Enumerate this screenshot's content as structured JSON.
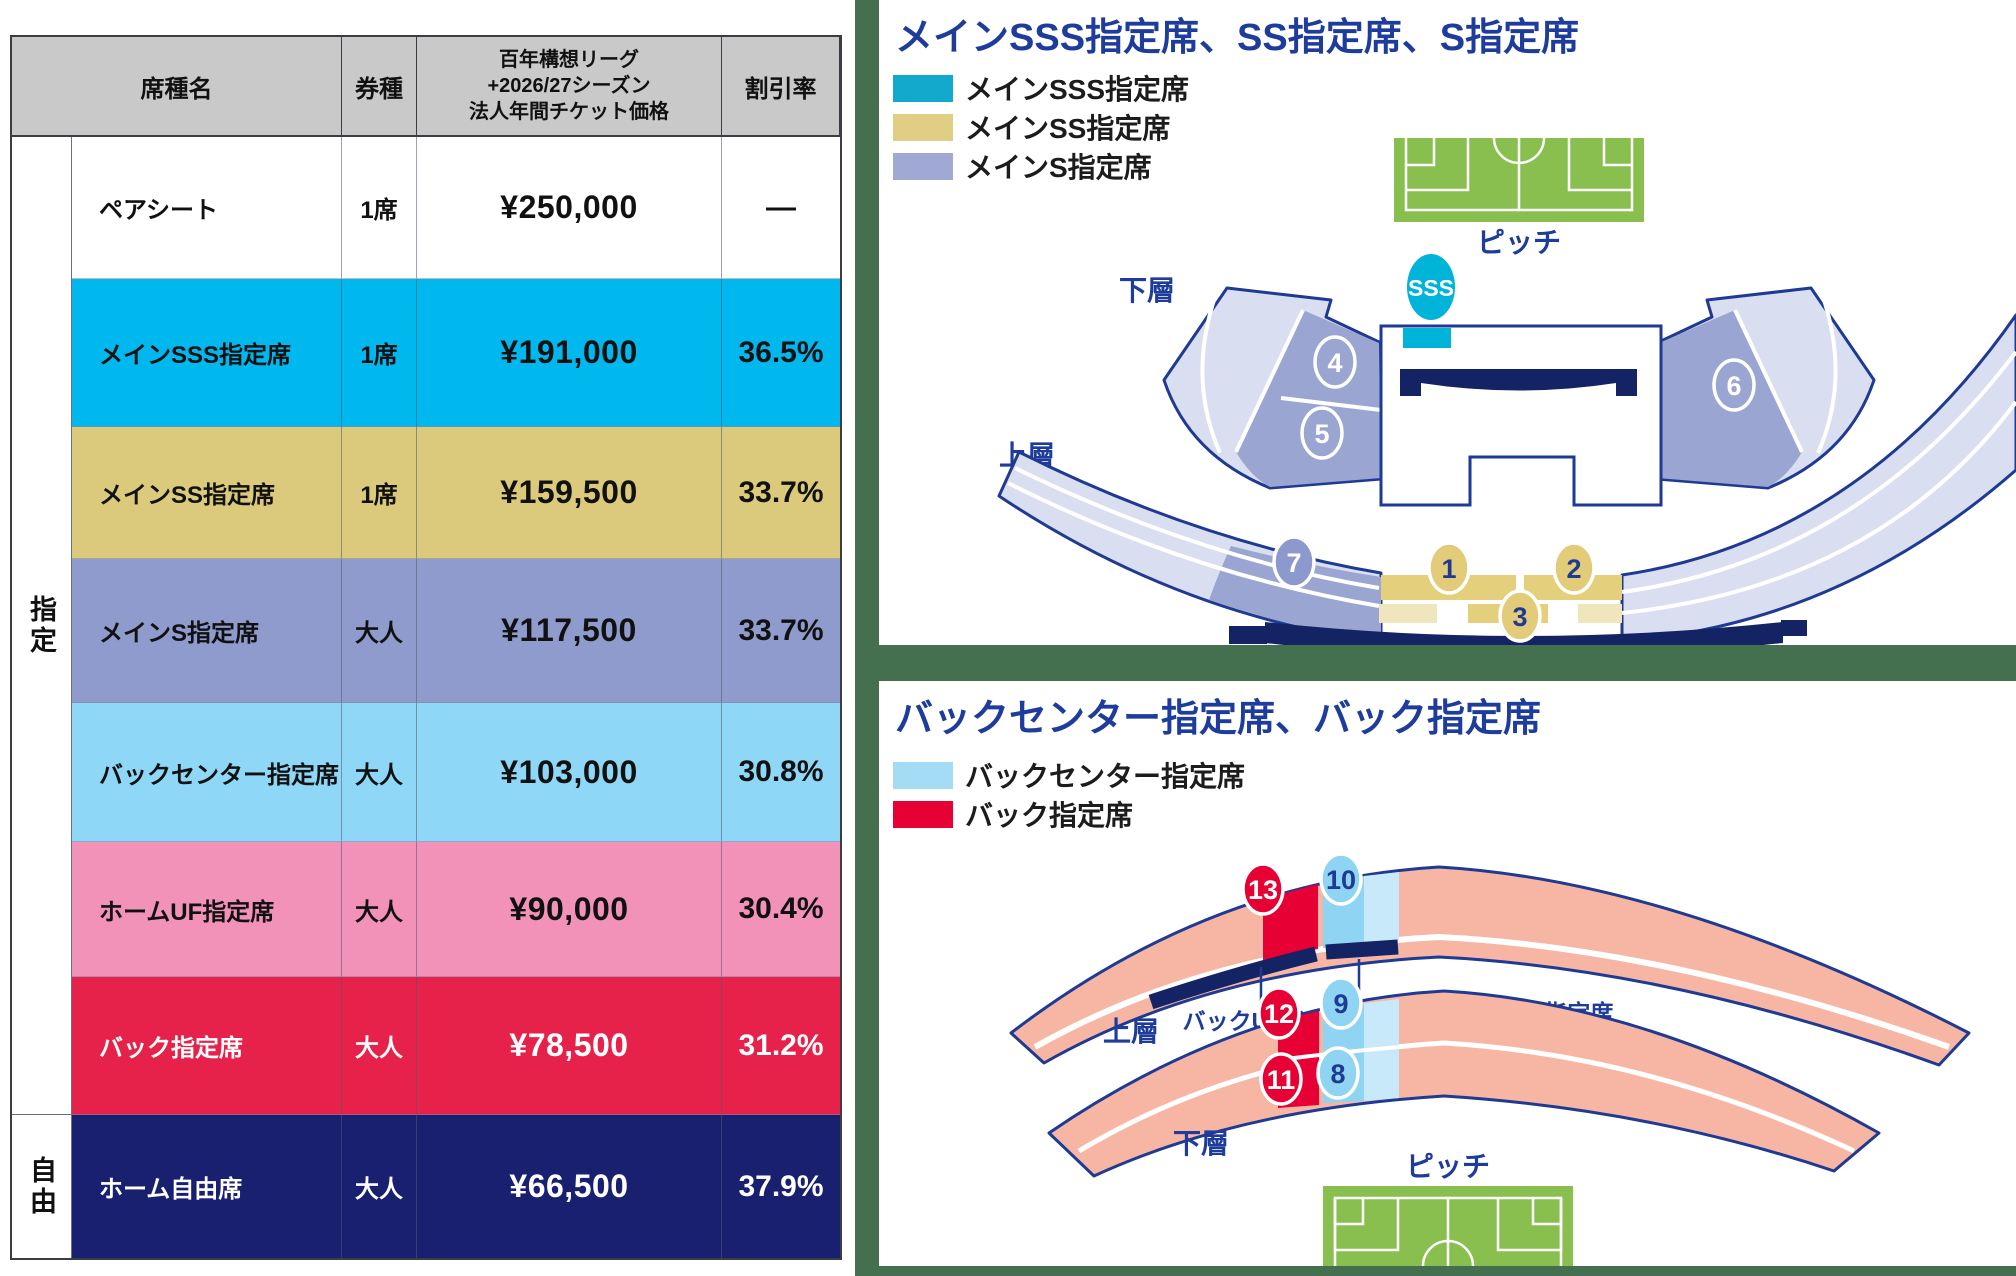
{
  "colors": {
    "green_background": "#447050",
    "table_header_bg": "#c9c9ca",
    "row_sss": "#00b8ee",
    "row_ss": "#dcca7c",
    "row_s": "#8e9bcc",
    "row_back_center": "#8ed7f6",
    "row_home_uf": "#f292b9",
    "row_back": "#e6224a",
    "row_home_free": "#1a2070",
    "map_outline_blue": "#1e3a93",
    "map_dark_navy": "#132364",
    "pitch_green": "#88bf4e",
    "stand_light": "#d9def0",
    "stand_mid": "#9aa5d1",
    "sss_cyan": "#00b3d8",
    "legend_sss": "#12a9cc",
    "legend_ss": "#e0ce84",
    "legend_s": "#9fa9d4",
    "legend_back_center": "#a5dcf5",
    "legend_back": "#e60033",
    "salmon": "#f7b5a4",
    "section_blue_dark": "#8fd4f2",
    "section_blue_light": "#c8e9f9"
  },
  "table": {
    "headers": {
      "seat_name": "席種名",
      "ticket_type": "券種",
      "price": "百年構想リーグ\n+2026/27シーズン\n法人年間チケット価格",
      "discount": "割引率"
    },
    "row_groups": [
      {
        "label": "指定",
        "span": 7
      },
      {
        "label": "自由",
        "span": 1
      }
    ],
    "rows": [
      {
        "name": "ペアシート",
        "ticket": "1席",
        "price": "¥250,000",
        "discount": "—",
        "key": "pair"
      },
      {
        "name": "メインSSS指定席",
        "ticket": "1席",
        "price": "¥191,000",
        "discount": "36.5%",
        "key": "sss"
      },
      {
        "name": "メインSS指定席",
        "ticket": "1席",
        "price": "¥159,500",
        "discount": "33.7%",
        "key": "ss"
      },
      {
        "name": "メインS指定席",
        "ticket": "大人",
        "price": "¥117,500",
        "discount": "33.7%",
        "key": "s"
      },
      {
        "name": "バックセンター指定席",
        "ticket": "大人",
        "price": "¥103,000",
        "discount": "30.8%",
        "key": "back_center"
      },
      {
        "name": "ホームUF指定席",
        "ticket": "大人",
        "price": "¥90,000",
        "discount": "30.4%",
        "key": "home_uf"
      },
      {
        "name": "バック指定席",
        "ticket": "大人",
        "price": "¥78,500",
        "discount": "31.2%",
        "key": "back"
      },
      {
        "name": "ホーム自由席",
        "ticket": "大人",
        "price": "¥66,500",
        "discount": "37.9%",
        "key": "home_free"
      }
    ]
  },
  "maps": {
    "top": {
      "title": "メインSSS指定席、SS指定席、S指定席",
      "legend": [
        {
          "label": "メインSSS指定席",
          "key": "legend_sss"
        },
        {
          "label": "メインSS指定席",
          "key": "legend_ss"
        },
        {
          "label": "メインS指定席",
          "key": "legend_s"
        }
      ],
      "labels": {
        "pitch": "ピッチ",
        "lower_tier": "下層",
        "upper_tier": "上層",
        "sss_badge": "SSS"
      },
      "markers": [
        {
          "label": "1",
          "kind": "ss"
        },
        {
          "label": "2",
          "kind": "ss"
        },
        {
          "label": "3",
          "kind": "ss"
        },
        {
          "label": "4",
          "kind": "s_outline"
        },
        {
          "label": "5",
          "kind": "s_outline"
        },
        {
          "label": "6",
          "kind": "s_outline"
        },
        {
          "label": "7",
          "kind": "s_fill"
        }
      ]
    },
    "bottom": {
      "title": "バックセンター指定席、バック指定席",
      "legend": [
        {
          "label": "バックセンター指定席",
          "key": "legend_back_center"
        },
        {
          "label": "バック指定席",
          "key": "legend_back"
        }
      ],
      "labels": {
        "pitch": "ピッチ",
        "lower_tier": "下層",
        "upper_tier": "上層",
        "back_uf": "バックUF指定席",
        "back_center_uf": "バックセンターUF指定席"
      },
      "markers": [
        {
          "label": "8",
          "kind": "bc"
        },
        {
          "label": "9",
          "kind": "bc"
        },
        {
          "label": "10",
          "kind": "bc"
        },
        {
          "label": "11",
          "kind": "back"
        },
        {
          "label": "12",
          "kind": "back"
        },
        {
          "label": "13",
          "kind": "back"
        }
      ]
    }
  }
}
